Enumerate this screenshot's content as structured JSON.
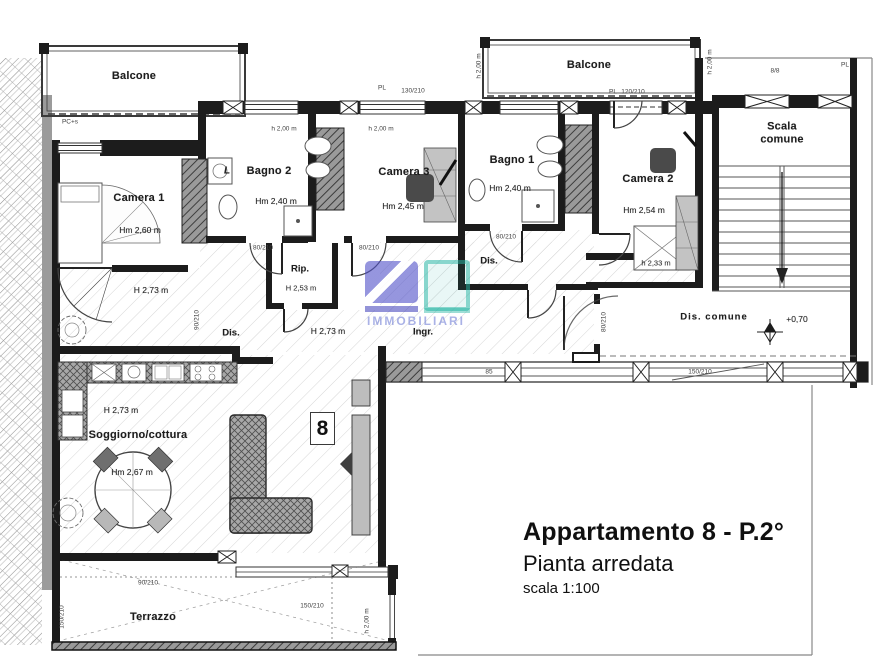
{
  "title_block": {
    "line1": "Appartamento 8 - P.2°",
    "line2": "Pianta arredata",
    "line3": "scala 1:100"
  },
  "badge": {
    "number": "8"
  },
  "watermark": {
    "text": "IMMOBILIARI",
    "accent_blue": "#4f4fc8",
    "accent_teal": "#27b5a5"
  },
  "colors": {
    "wall": "#1c1c1c",
    "hatch": "#9a9a9a",
    "paper": "#ffffff"
  },
  "rooms": {
    "balcone1": {
      "name": "Balcone"
    },
    "balcone2": {
      "name": "Balcone"
    },
    "scala": {
      "name": "Scala comune"
    },
    "camera1": {
      "name": "Camera 1",
      "height": "Hm 2,60 m"
    },
    "bagno2": {
      "name": "Bagno 2",
      "height": "Hm 2,40 m",
      "appliance": "L"
    },
    "camera3": {
      "name": "Camera 3",
      "height": "Hm 2,45 m"
    },
    "bagno1": {
      "name": "Bagno 1",
      "height": "Hm 2,40 m"
    },
    "camera2": {
      "name": "Camera 2",
      "height": "Hm 2,54 m",
      "low_height": "h 2,33 m"
    },
    "rip": {
      "name": "Rip.",
      "height": "H 2,53 m"
    },
    "dis_left": {
      "name": "Dis.",
      "height": "H 2,73 m"
    },
    "dis_right": {
      "name": "Dis."
    },
    "ingr": {
      "name": "Ingr.",
      "height": "H 2,73 m"
    },
    "dis_comune": {
      "name": "Dis. comune",
      "elevation": "+0,70"
    },
    "soggiorno": {
      "name": "Soggiorno/cottura",
      "height": "H 2,73 m",
      "table_height": "Hm 2,67 m"
    },
    "terrazzo": {
      "name": "Terrazzo"
    }
  },
  "dim_labels": [
    {
      "t": "PC+s",
      "x": 70,
      "y": 122,
      "r": 0
    },
    {
      "t": "PL",
      "x": 382,
      "y": 88,
      "r": 0
    },
    {
      "t": "130/210",
      "x": 413,
      "y": 91,
      "r": 0
    },
    {
      "t": "h 2,00 m",
      "x": 284,
      "y": 129,
      "r": 0
    },
    {
      "t": "h 2,00 m",
      "x": 381,
      "y": 129,
      "r": 0
    },
    {
      "t": "h 2,00 m",
      "x": 479,
      "y": 66,
      "r": -90
    },
    {
      "t": "PL",
      "x": 613,
      "y": 92,
      "r": 0
    },
    {
      "t": "120/210",
      "x": 633,
      "y": 92,
      "r": 0
    },
    {
      "t": "h 2,00 m",
      "x": 710,
      "y": 62,
      "r": -90
    },
    {
      "t": "8/8",
      "x": 775,
      "y": 71,
      "r": 0
    },
    {
      "t": "PL",
      "x": 845,
      "y": 65,
      "r": 0
    },
    {
      "t": "90/210",
      "x": 197,
      "y": 320,
      "r": -90
    },
    {
      "t": "80/210",
      "x": 263,
      "y": 248,
      "r": 0
    },
    {
      "t": "80/210",
      "x": 369,
      "y": 248,
      "r": 0
    },
    {
      "t": "80/210",
      "x": 506,
      "y": 237,
      "r": 0
    },
    {
      "t": "80/210",
      "x": 604,
      "y": 322,
      "r": -90
    },
    {
      "t": "85",
      "x": 489,
      "y": 372,
      "r": 0
    },
    {
      "t": "150/210",
      "x": 700,
      "y": 372,
      "r": 0
    },
    {
      "t": "90/210",
      "x": 148,
      "y": 583,
      "r": 0
    },
    {
      "t": "150/210",
      "x": 312,
      "y": 606,
      "r": 0
    },
    {
      "t": "150/210",
      "x": 62,
      "y": 617,
      "r": -90
    },
    {
      "t": "h 2,00 m",
      "x": 367,
      "y": 621,
      "r": -90
    }
  ]
}
